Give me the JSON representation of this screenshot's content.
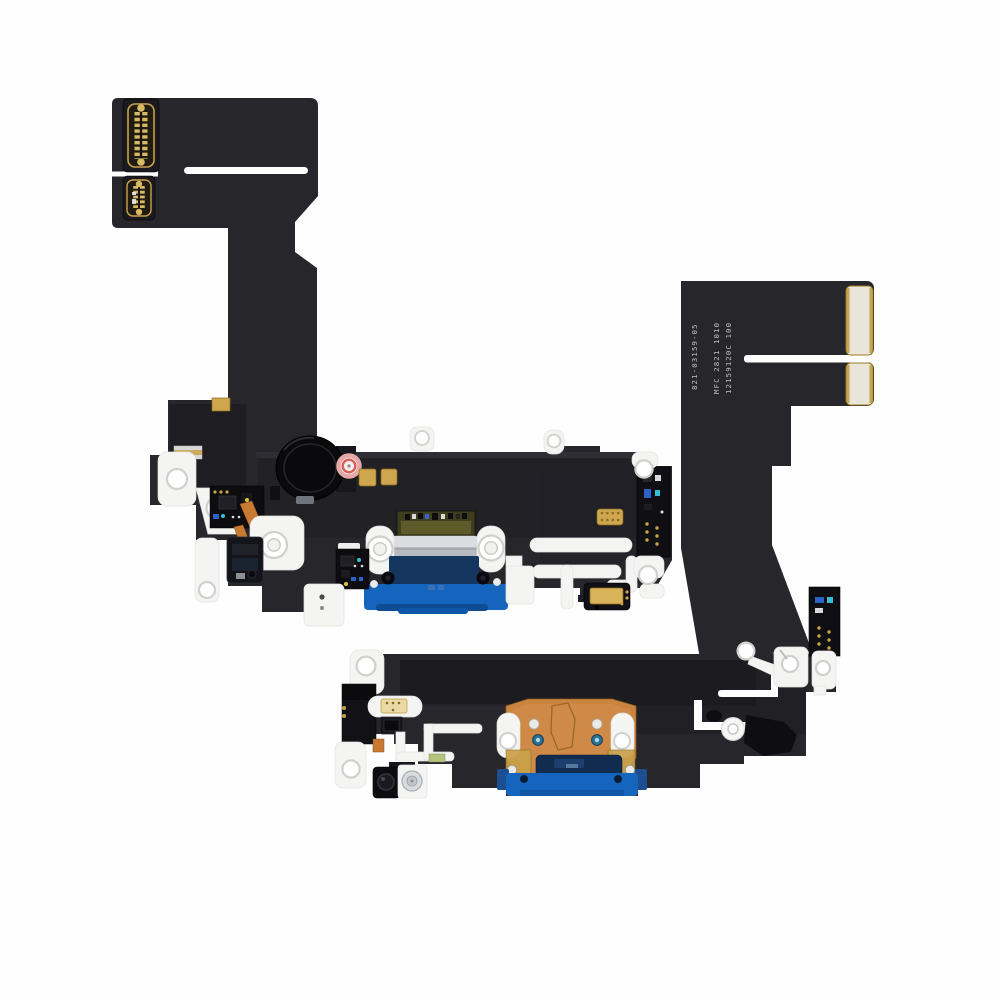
{
  "figure": {
    "subject": "iPhone 13 charging port flex cable in blue, shown from front (top) and back (bottom)"
  },
  "printed_labels": {
    "apple_part_number": "821-03159-05",
    "mfc_code": "MFC 2821 1010",
    "lot_code": "12159120C 100"
  },
  "colors": {
    "background": "#fefefe",
    "flex_body": "#26262b",
    "flex_dark": "#18181c",
    "flex_black": "#0e0e12",
    "white_plastic": "#f4f4f2",
    "silver_metal": "#b7bbbf",
    "silver_light": "#dadde0",
    "gold": "#cfa54e",
    "pad_cream": "#eae5d9",
    "copper": "#c98440",
    "copper_strip": "#c87a33",
    "blue_bright": "#1565be",
    "blue_navy": "#15365e",
    "port_navy": "#122c50",
    "seal_red": "#d95f55",
    "seal_pink": "#eaa9a9",
    "teal_rivet": "#2e6f8f",
    "olive_pcb": "#3f3e1e",
    "label_text": "#c9ced4"
  }
}
